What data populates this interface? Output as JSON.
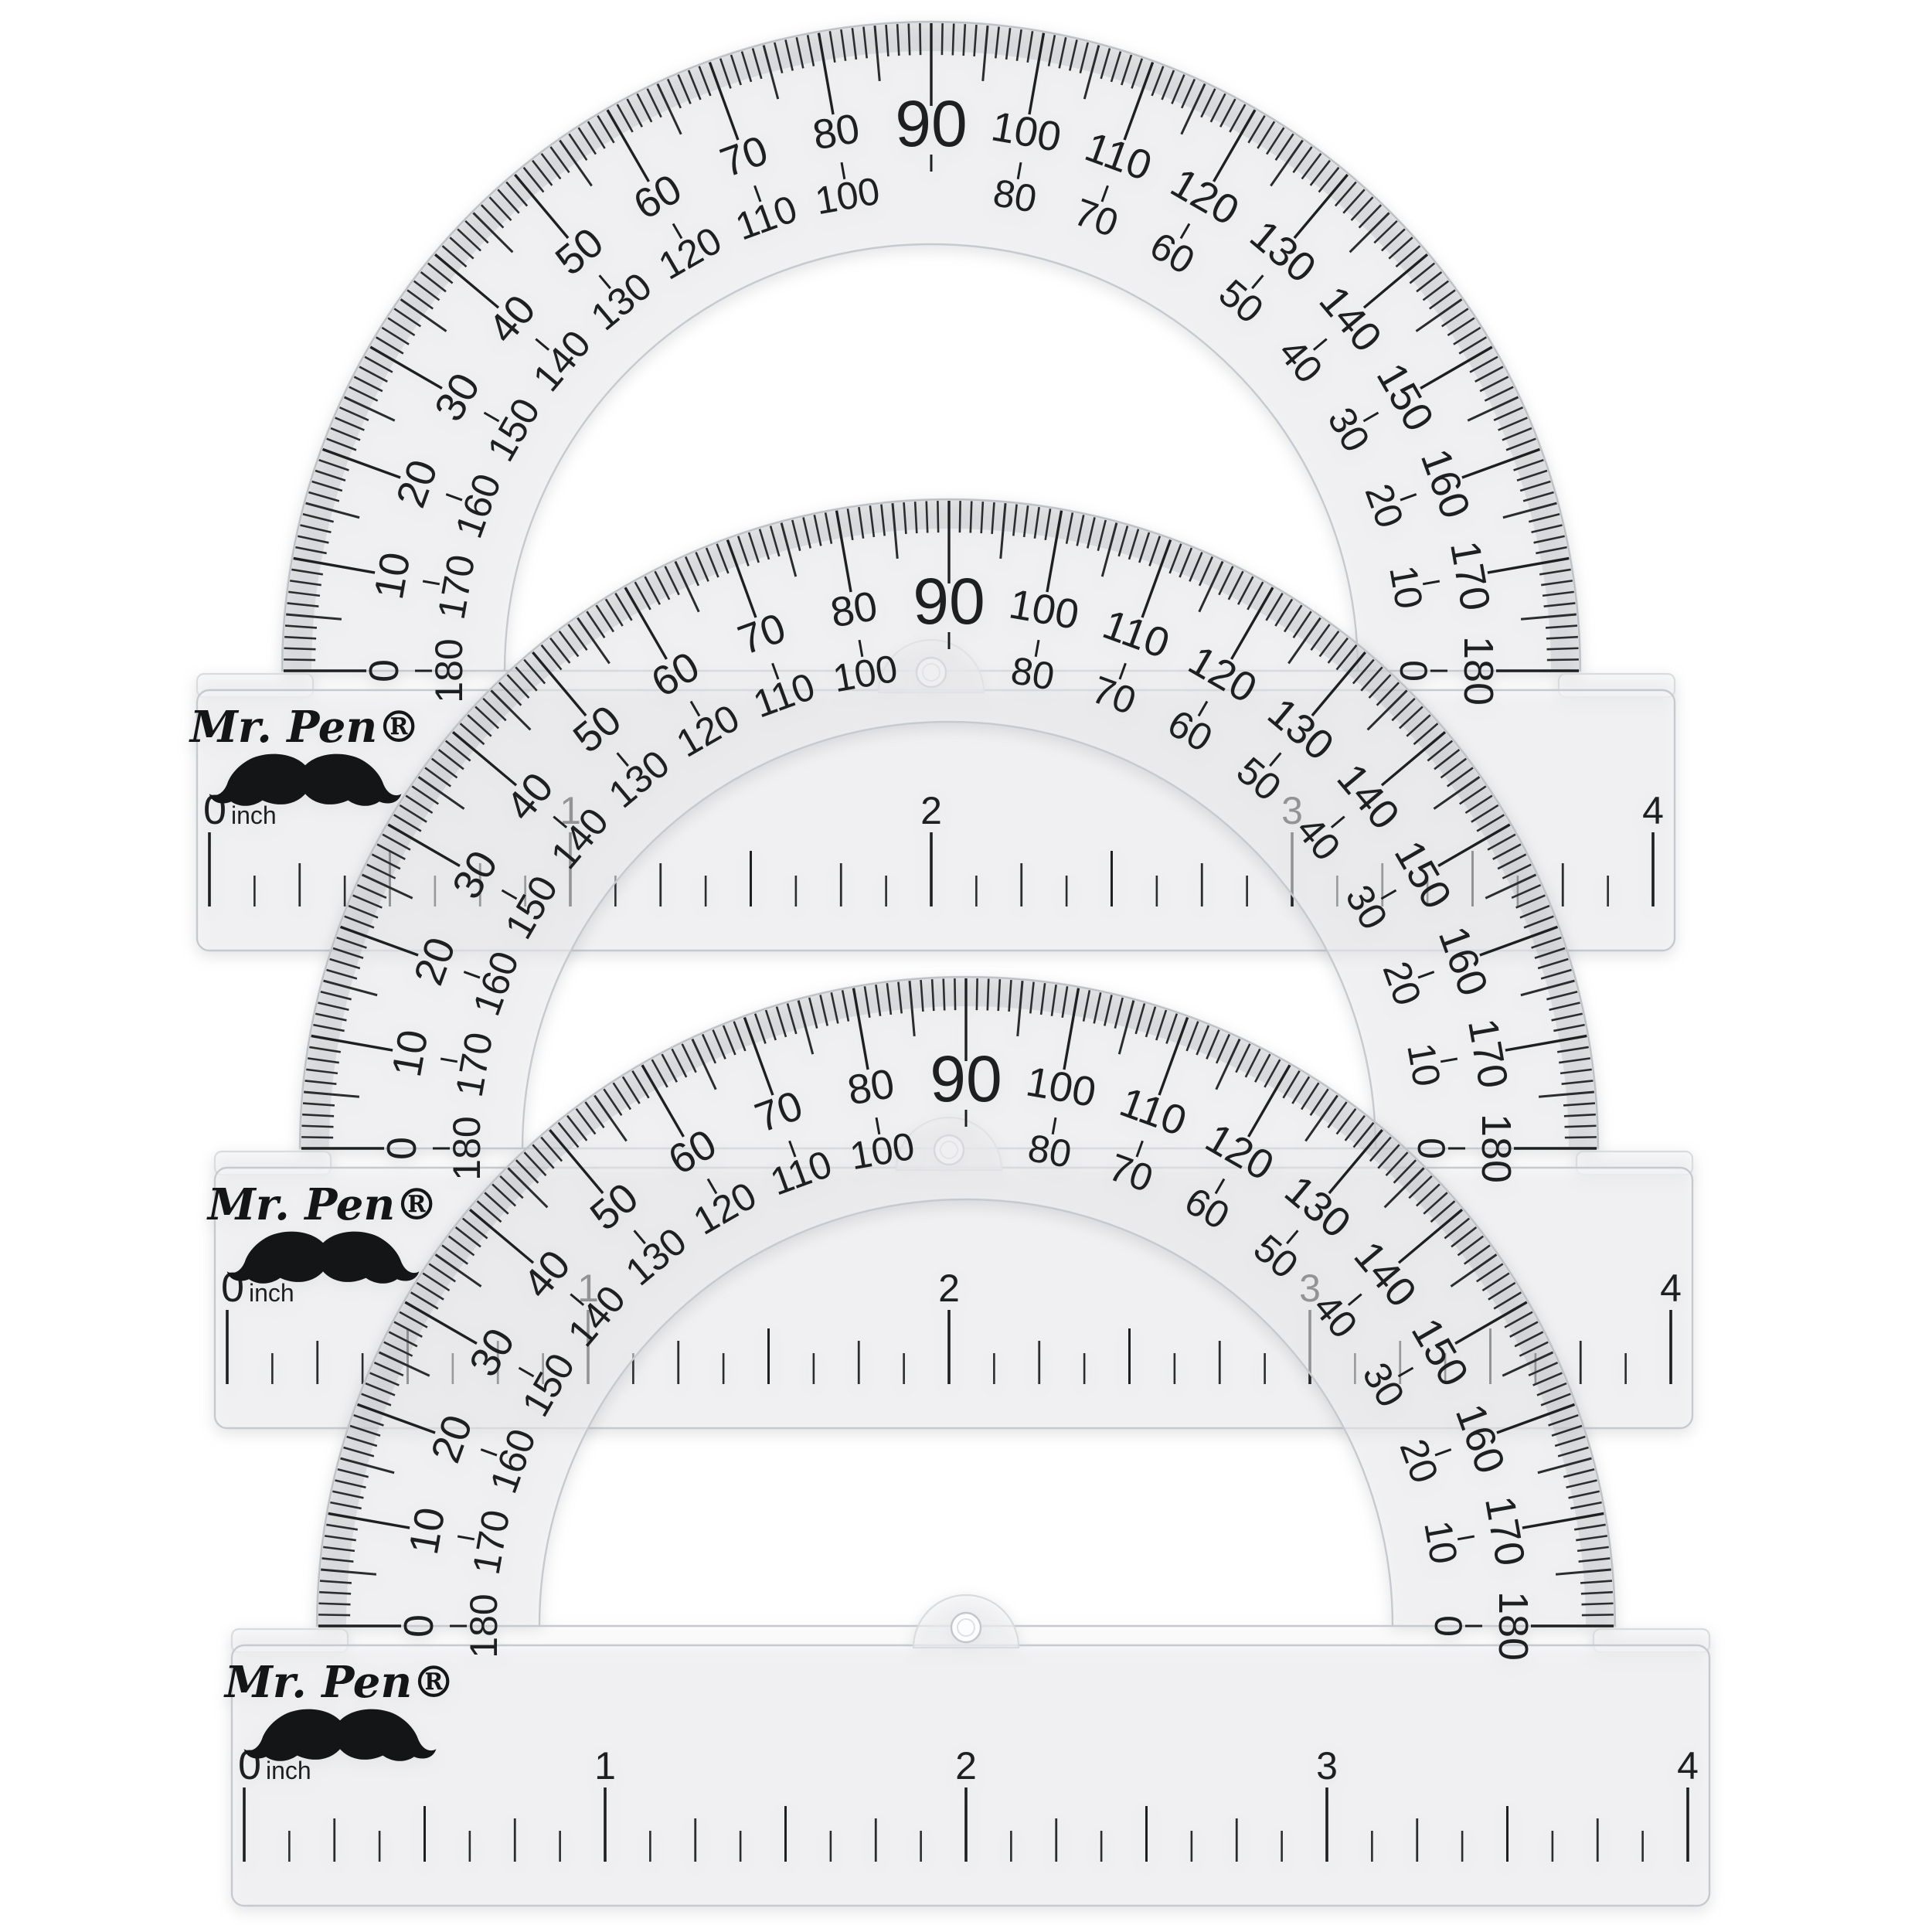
{
  "scene": {
    "description": "Three transparent Mr. Pen 4-inch student protractors stacked with vertical offsets on a white background",
    "background_color": "#ffffff"
  },
  "brand": {
    "logo_text": "Mr. Pen®",
    "mustache_icon": "mustache-icon"
  },
  "colors": {
    "print": "#1e1f21",
    "print_soft": "#2b2c2e",
    "plastic_fill": "rgba(247,248,250,0.52)",
    "plastic_edge": "#c6cacf",
    "plastic_edge_soft": "#d9dcdf",
    "bevel_shade": "rgba(110,116,124,0.16)",
    "hole_ring": "#c2c6cb"
  },
  "protractors": {
    "count": 3,
    "origins": [
      [
        1205,
        868
      ],
      [
        1228,
        1486
      ],
      [
        1250,
        2104
      ]
    ]
  },
  "degree_scale": {
    "outer_labels": [
      "0",
      "10",
      "20",
      "30",
      "40",
      "50",
      "60",
      "70",
      "80",
      "90",
      "100",
      "110",
      "120",
      "130",
      "140",
      "150",
      "160",
      "170",
      "180"
    ],
    "inner_labels": [
      "180",
      "170",
      "160",
      "150",
      "140",
      "130",
      "120",
      "110",
      "100",
      "",
      "80",
      "70",
      "60",
      "50",
      "40",
      "30",
      "20",
      "10",
      "0"
    ],
    "apex_label": "90",
    "tick_step_degrees": 1,
    "medium_tick_every": 5,
    "major_tick_every": 10
  },
  "ruler": {
    "zero_label": "0",
    "unit_label": "inch",
    "mid_labels": [
      "1",
      "2",
      "3"
    ],
    "end_label": "4",
    "inches": 4,
    "divisions_per_inch": 8
  }
}
